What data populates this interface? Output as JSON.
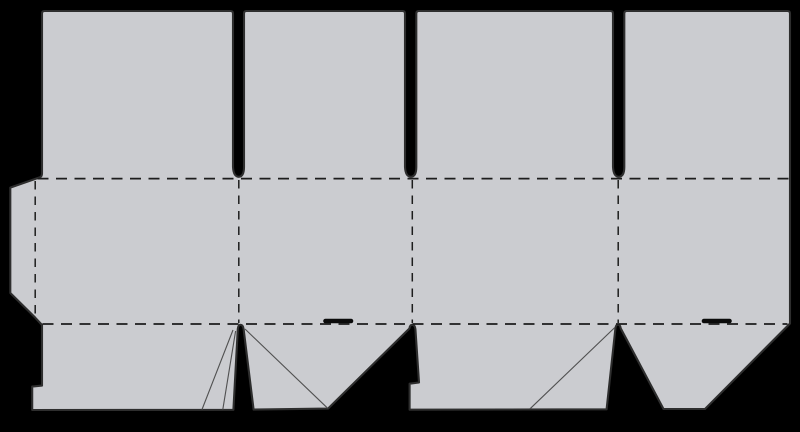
{
  "diagram": {
    "type": "packaging-dieline",
    "description": "Flat carton box dieline template on a black background: a left glue tab, four body panels divided by dashed fold lines, four tall top closure flaps separated by narrow slots, and four crash-lock bottom flaps with diagonal crease lines and two tuck slits",
    "colors": {
      "background": "#000000",
      "board_fill": "#cbccd0",
      "cut_line": "#2e2e2e",
      "fold_line": "#1d1d1d",
      "crease_line": "#505050",
      "slit": "#0b0b0b"
    },
    "counts": {
      "top_flaps": 4,
      "body_panels": 4,
      "bottom_flaps": 4,
      "glue_tabs": 1,
      "tuck_slits": 2,
      "crease_lines": 4
    }
  }
}
